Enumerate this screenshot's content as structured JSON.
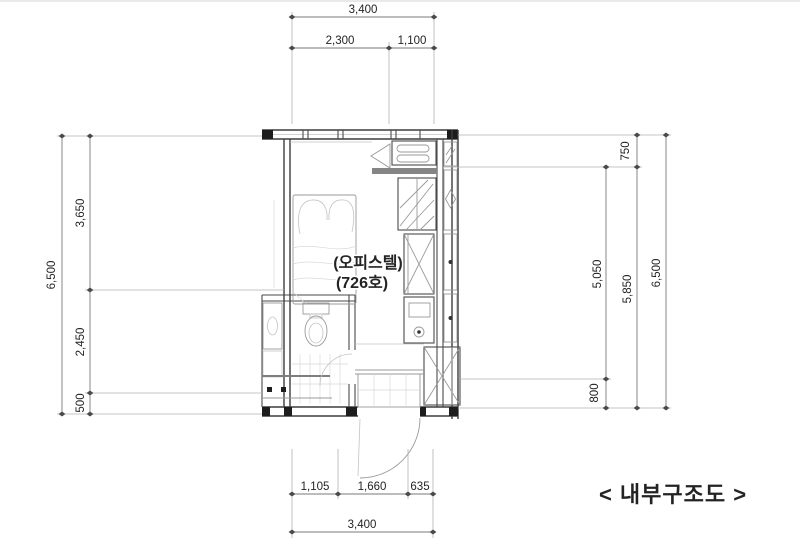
{
  "labels": {
    "room_name": "(오피스텔)",
    "room_number": "(726호)",
    "drawing_title": "< 내부구조도 >"
  },
  "dimensions": {
    "top": {
      "total": "3,400",
      "left_segment": "2,300",
      "right_segment": "1,100"
    },
    "bottom": {
      "segment_1": "1,105",
      "segment_2": "1,660",
      "segment_3": "635",
      "total": "3,400"
    },
    "left": {
      "overall": "6,500",
      "upper": "3,650",
      "middle": "2,450",
      "lower": "500"
    },
    "right": {
      "upper": "750",
      "inner_span": "5,050",
      "lower": "800",
      "middle_total": "5,850",
      "overall": "6,500"
    }
  },
  "colors": {
    "line": "#4a4a4a",
    "dim_line": "#7a7a7a",
    "text": "#232323",
    "background": "#ffffff"
  }
}
